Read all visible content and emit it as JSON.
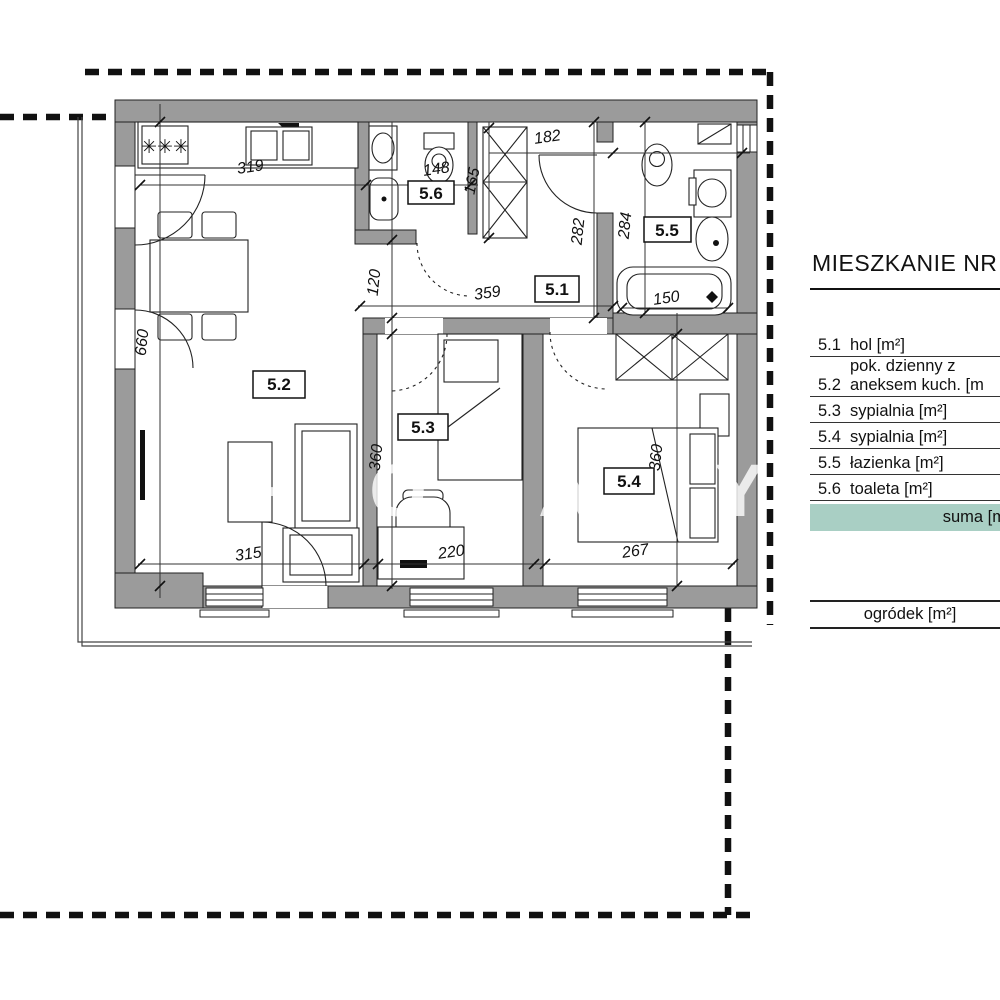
{
  "header": {
    "title": "MIESZKANIE NR"
  },
  "legend": {
    "rows": [
      {
        "no": "5.1",
        "label": "hol [m²]"
      },
      {
        "no": "5.2",
        "label_line1": "pok. dzienny z",
        "label_line2": "aneksem kuch. [m"
      },
      {
        "no": "5.3",
        "label": "sypialnia [m²]"
      },
      {
        "no": "5.4",
        "label": "sypialnia [m²]"
      },
      {
        "no": "5.5",
        "label": "łazienka [m²]"
      },
      {
        "no": "5.6",
        "label": "toaleta [m²]"
      }
    ],
    "suma_label": "suma [m",
    "ogrodek_label": "ogródek [m²]"
  },
  "plan": {
    "room_labels": {
      "hall": "5.1",
      "living": "5.2",
      "bedroom1": "5.3",
      "bedroom2": "5.4",
      "bathroom": "5.5",
      "toilet": "5.6"
    },
    "dimensions": {
      "kitchen_width": "319",
      "toilet_width": "148",
      "wardrobe_depth": "165",
      "hall_top": "182",
      "hall_right_height": "282",
      "bathroom_height": "284",
      "hall_left_height": "120",
      "hall_width": "359",
      "living_height": "660",
      "bedroom1_height": "360",
      "bedroom2_height": "360",
      "living_width": "315",
      "bedroom1_width": "220",
      "bedroom2_width": "267",
      "bathtub_length": "150"
    },
    "stove_burners": "✳✳✳",
    "watermark_letters": [
      "H",
      "O",
      "A",
      "Y"
    ],
    "colors": {
      "wall": "#9b9b9b",
      "suma_row": "#a9cfc4"
    }
  }
}
